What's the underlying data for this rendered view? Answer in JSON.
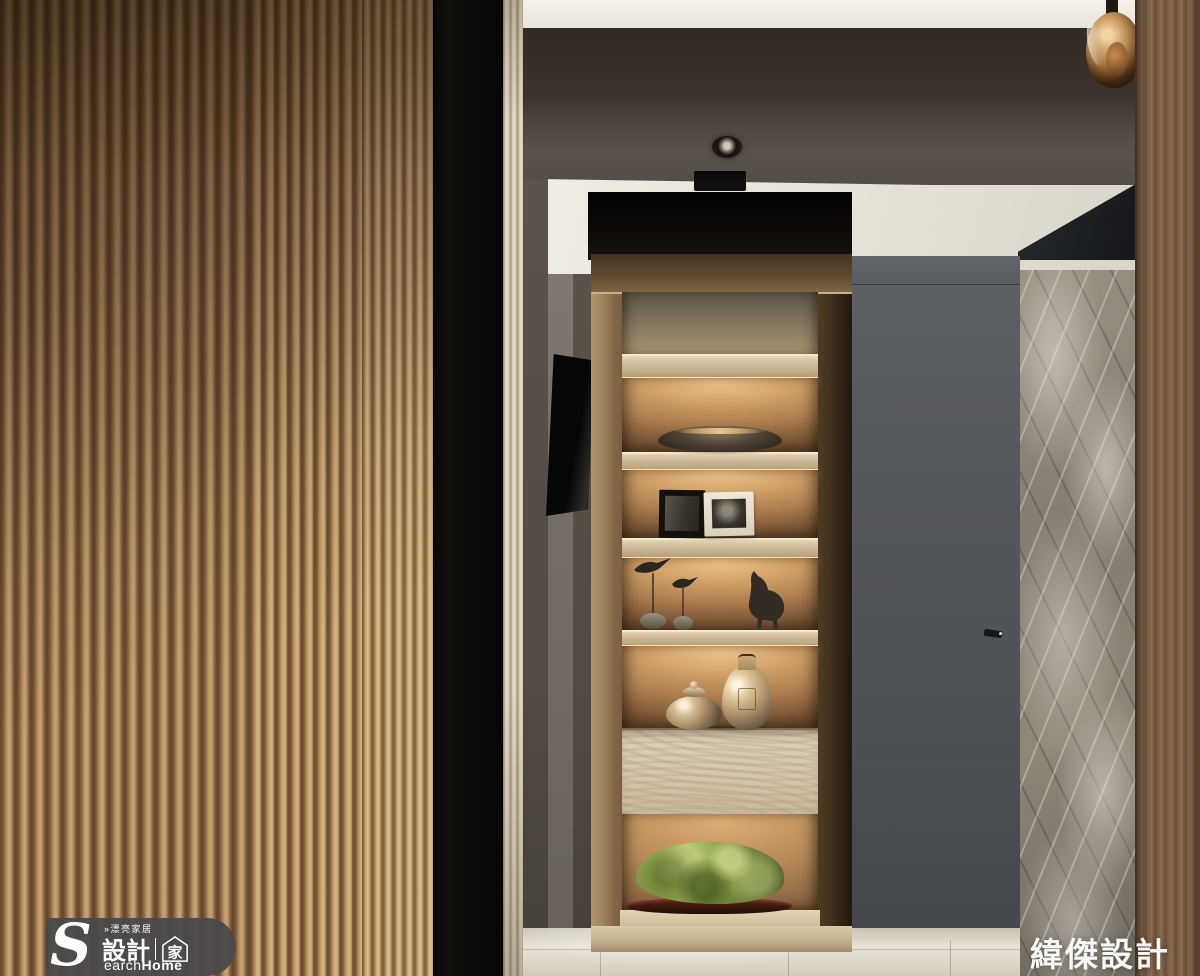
{
  "watermarks": {
    "logo": {
      "tagline": "»漂亮家居",
      "brand_initial": "S",
      "brand_zh": "設計",
      "brand_house_char": "家",
      "brand_en_rest": "earch",
      "brand_en_bold": "Home"
    },
    "credit": "緯傑設計"
  },
  "palette": {
    "slat_light": "#c8a674",
    "slat_dark": "#64452a",
    "divider_black": "#0d0b0a",
    "fluted_trim": "#d8cdb7",
    "hall_wall_gray": "#58514a",
    "ceiling_beam": "#3b322c",
    "ceiling_white": "#efece3",
    "shelf_niche_black": "#060504",
    "shelf_walnut": "#5f4831",
    "shelf_oak": "#d6c4a2",
    "backlight_glow": "#d2a269",
    "led_strip": "#ffdfa8",
    "door_gray": "#53565a",
    "marble_gray": "#8e8679",
    "column_wood": "#7d6349",
    "floor_tile": "#e7e2d5",
    "vase_copper": "#d5bb90",
    "stone_green": "#7c9140",
    "stone_base_red": "#3c1710",
    "pendant_amber": "#d2a468",
    "tv_black": "#060606"
  },
  "scene": {
    "objects": [
      "wood-slat-wall",
      "black-divider-panel",
      "fluted-trim",
      "hallway-wall",
      "ceiling-beam",
      "recessed-downlight",
      "ceiling-vent",
      "pendant-glass-globe",
      "wall-tv",
      "display-shelf",
      "decor-bowl",
      "photo-frame-dark",
      "photo-frame-light",
      "bird-sculptures",
      "horse-figurine",
      "metallic-vases",
      "wood-drawer",
      "green-stone-sculpture",
      "gray-door",
      "door-handle",
      "marble-wall",
      "wood-column",
      "tile-floor"
    ]
  }
}
